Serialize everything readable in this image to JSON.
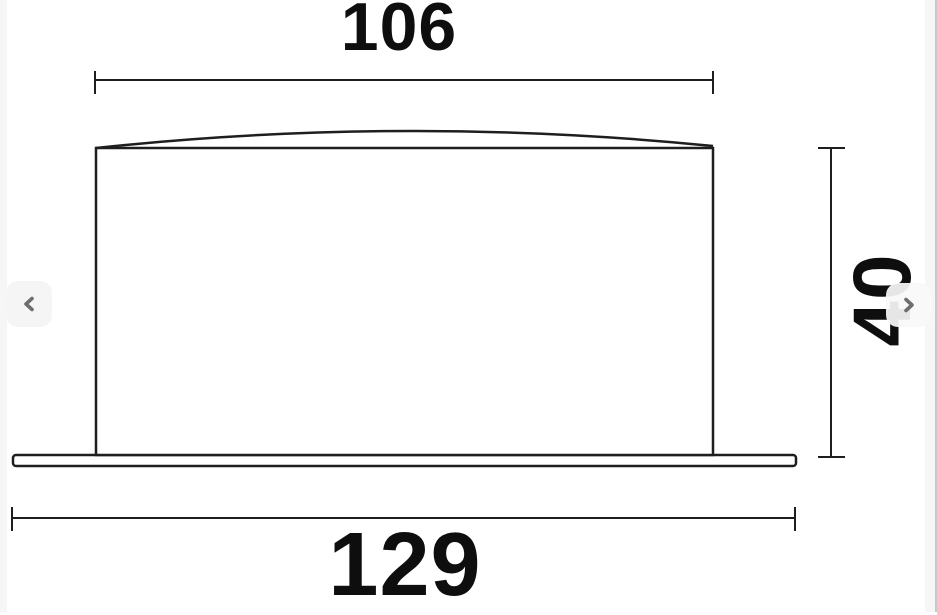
{
  "page": {
    "background_color": "#ffffff",
    "side_gutter_color": "#f6f6f6",
    "right_edge_line_color": "#c9c9c9"
  },
  "diagram": {
    "kind": "technical-dimension-drawing",
    "line_color": "#1e1e1e",
    "text_color": "#0e0e0e",
    "dimensions": {
      "top_width": "106",
      "overall_width": "129",
      "height": "40"
    }
  },
  "carousel": {
    "icons": {
      "prev": "chevron-left",
      "next": "chevron-right"
    },
    "arrow_color": "#6e6e6e",
    "button_background": "#f5f5f5"
  }
}
